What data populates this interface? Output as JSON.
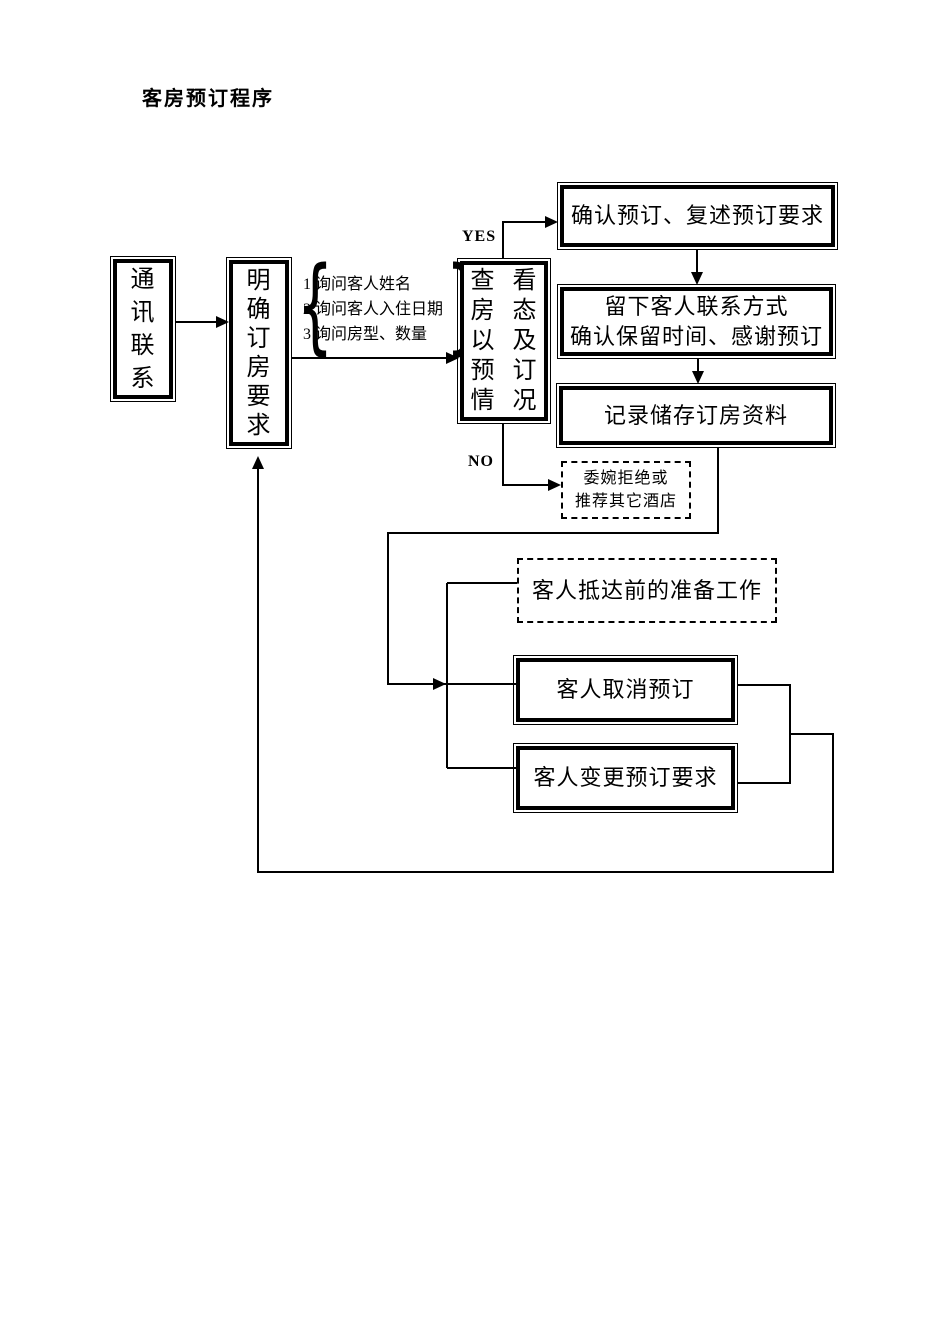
{
  "page": {
    "title": "客房预订程序"
  },
  "labels": {
    "yes": "YES",
    "no": "NO",
    "brace_left": "{",
    "brace_right": "}"
  },
  "nodes": {
    "contact": {
      "label": "通讯联系"
    },
    "clarify": {
      "label": "明确订房要求"
    },
    "inquiry": {
      "items": [
        "1 询问客人姓名",
        "2 询问客人入住日期",
        "3 询问房型、数量"
      ]
    },
    "check_status": {
      "column1": "查房以预情",
      "column2": "看态及订况"
    },
    "confirm": {
      "label": "确认预订、复述预订要求"
    },
    "keep_contact": {
      "line1": "留下客人联系方式",
      "line2": "确认保留时间、感谢预订"
    },
    "record": {
      "label": "记录储存订房资料"
    },
    "decline": {
      "line1": "委婉拒绝或",
      "line2": "推荐其它酒店"
    },
    "prepare": {
      "label": "客人抵达前的准备工作"
    },
    "cancel": {
      "label": "客人取消预订"
    },
    "change": {
      "label": "客人变更预订要求"
    }
  },
  "colors": {
    "ink": "#000000",
    "background": "#ffffff"
  }
}
